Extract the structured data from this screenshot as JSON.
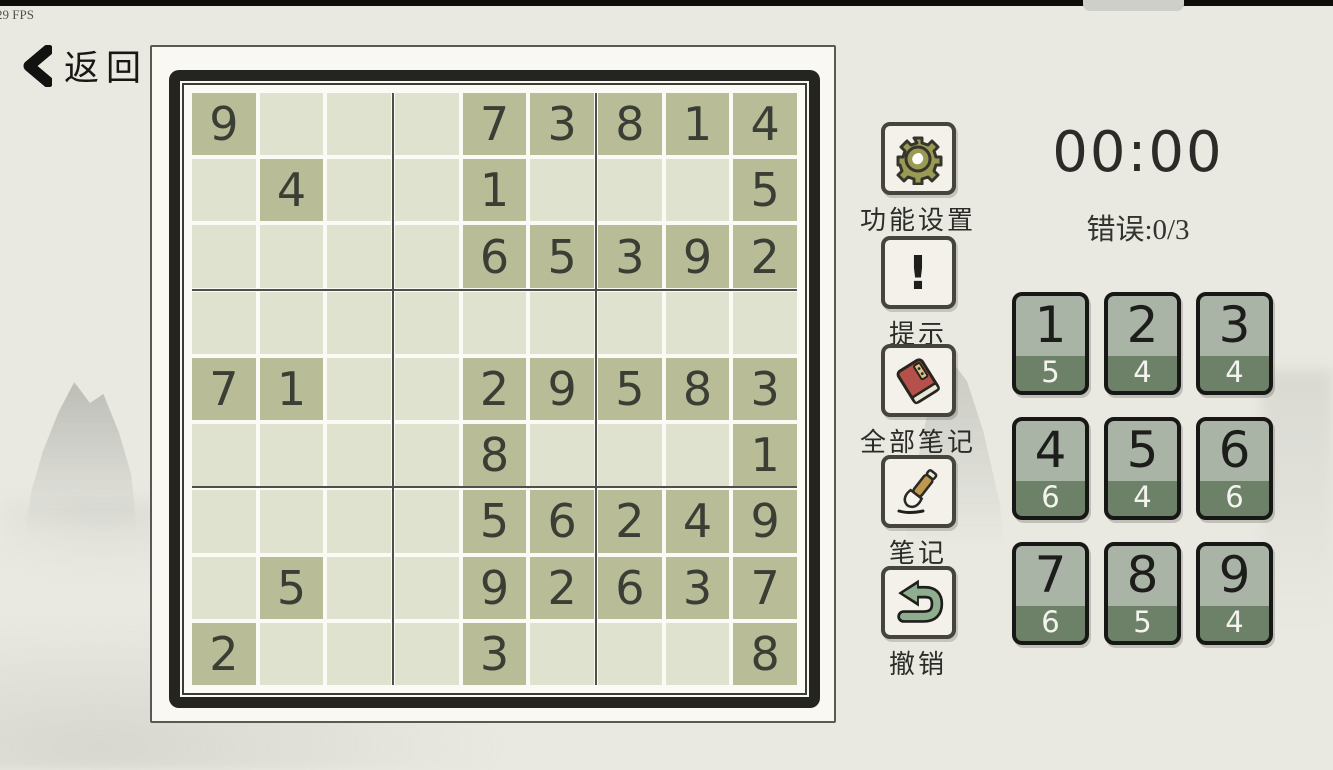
{
  "top_bar": {
    "fps": "29 FPS"
  },
  "back_button": {
    "label": "返回",
    "icon": "chevron-left-icon"
  },
  "board": {
    "rows": 9,
    "cols": 9,
    "given_color": "#b9bd97",
    "empty_color": "#dfe2ce",
    "cells": [
      [
        "9",
        "",
        "",
        "",
        "7",
        "3",
        "8",
        "1",
        "4"
      ],
      [
        "",
        "4",
        "",
        "",
        "1",
        "",
        "",
        "",
        "5"
      ],
      [
        "",
        "",
        "",
        "",
        "6",
        "5",
        "3",
        "9",
        "2"
      ],
      [
        "",
        "",
        "",
        "",
        "",
        "",
        "",
        "",
        ""
      ],
      [
        "7",
        "1",
        "",
        "",
        "2",
        "9",
        "5",
        "8",
        "3"
      ],
      [
        "",
        "",
        "",
        "",
        "8",
        "",
        "",
        "",
        "1"
      ],
      [
        "",
        "",
        "",
        "",
        "5",
        "6",
        "2",
        "4",
        "9"
      ],
      [
        "",
        "5",
        "",
        "",
        "9",
        "2",
        "6",
        "3",
        "7"
      ],
      [
        "2",
        "",
        "",
        "",
        "3",
        "",
        "",
        "",
        "8"
      ]
    ]
  },
  "toolbar": {
    "buttons": [
      {
        "label": "功能设置",
        "icon": "gear-icon"
      },
      {
        "label": "提示",
        "icon": "exclamation-icon"
      },
      {
        "label": "全部笔记",
        "icon": "book-icon"
      },
      {
        "label": "笔记",
        "icon": "brush-icon"
      },
      {
        "label": "撤销",
        "icon": "undo-icon"
      }
    ]
  },
  "status": {
    "timer": "00:00",
    "errors": "错误:0/3"
  },
  "numpad": {
    "card_top_color": "#a9b3a6",
    "card_bottom_color": "#6d8168",
    "cards": [
      {
        "digit": "1",
        "remaining": "5"
      },
      {
        "digit": "2",
        "remaining": "4"
      },
      {
        "digit": "3",
        "remaining": "4"
      },
      {
        "digit": "4",
        "remaining": "6"
      },
      {
        "digit": "5",
        "remaining": "4"
      },
      {
        "digit": "6",
        "remaining": "6"
      },
      {
        "digit": "7",
        "remaining": "6"
      },
      {
        "digit": "8",
        "remaining": "5"
      },
      {
        "digit": "9",
        "remaining": "4"
      }
    ]
  },
  "colors": {
    "gear_olive": "#9a9a55",
    "book_red": "#b5504b",
    "brush_tan": "#c0974e",
    "undo_green": "#8fae90",
    "frame_black": "#242421"
  }
}
